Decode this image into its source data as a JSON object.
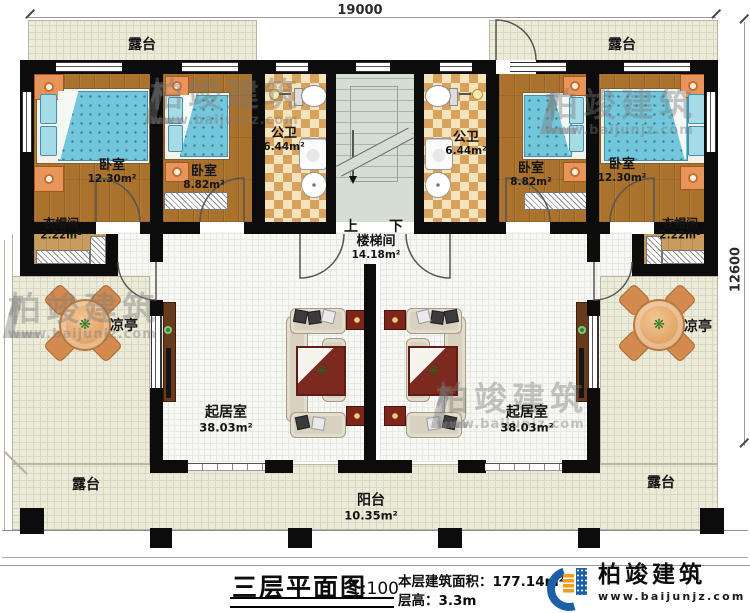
{
  "plan": {
    "dim_top": "19000",
    "dim_right": "12600",
    "rooms": {
      "terrace_tl": {
        "name": "露台"
      },
      "terrace_tr": {
        "name": "露台"
      },
      "bedroom1": {
        "name": "卧室",
        "area": "12.30m²"
      },
      "bedroom2": {
        "name": "卧室",
        "area": "8.82m²"
      },
      "bath_left": {
        "name": "公卫",
        "area": "6.44m²"
      },
      "stairwell": {
        "name": "楼梯间",
        "area": "14.18m²",
        "up_label": "上",
        "down_label": "下"
      },
      "bath_right": {
        "name": "公卫",
        "area": "6.44m²"
      },
      "bedroom3": {
        "name": "卧室",
        "area": "8.82m²"
      },
      "bedroom4": {
        "name": "卧室",
        "area": "12.30m²"
      },
      "cloak_left": {
        "name": "衣帽间",
        "area": "2.22m²"
      },
      "cloak_right": {
        "name": "衣帽间",
        "area": "2.22m²"
      },
      "pavilion_left": {
        "name": "凉亭"
      },
      "pavilion_right": {
        "name": "凉亭"
      },
      "living_left": {
        "name": "起居室",
        "area": "38.03m²"
      },
      "living_right": {
        "name": "起居室",
        "area": "38.03m²"
      },
      "terrace_bl": {
        "name": "露台"
      },
      "terrace_br": {
        "name": "露台"
      },
      "balcony": {
        "name": "阳台",
        "area": "10.35m²"
      }
    }
  },
  "titleblock": {
    "title": "三层平面图",
    "scale": "1:100",
    "area_label": "本层建筑面积：",
    "area_value": "177.14m²",
    "floor_height_label": "层高：",
    "floor_height_value": "3.3m"
  },
  "brand": {
    "name": "柏竣建筑",
    "url": "www.baijunjz.com"
  },
  "watermark": {
    "name": "柏竣建筑",
    "url": "www.baijunjz.com"
  },
  "icons": {
    "plant_icon": "✳",
    "flower_icon": "❋"
  },
  "colors": {
    "wall": "#0c0c0c",
    "wood_floor": "#aa722d",
    "bed_blue": "#74c6db",
    "terrace_floor": "#ecead9",
    "tile_accent": "#d9a25c",
    "stair_floor": "#d6ddd2",
    "rug_red": "#7c2a20",
    "logo_blue": "#1c5fa8",
    "logo_orange": "#f59c20"
  }
}
